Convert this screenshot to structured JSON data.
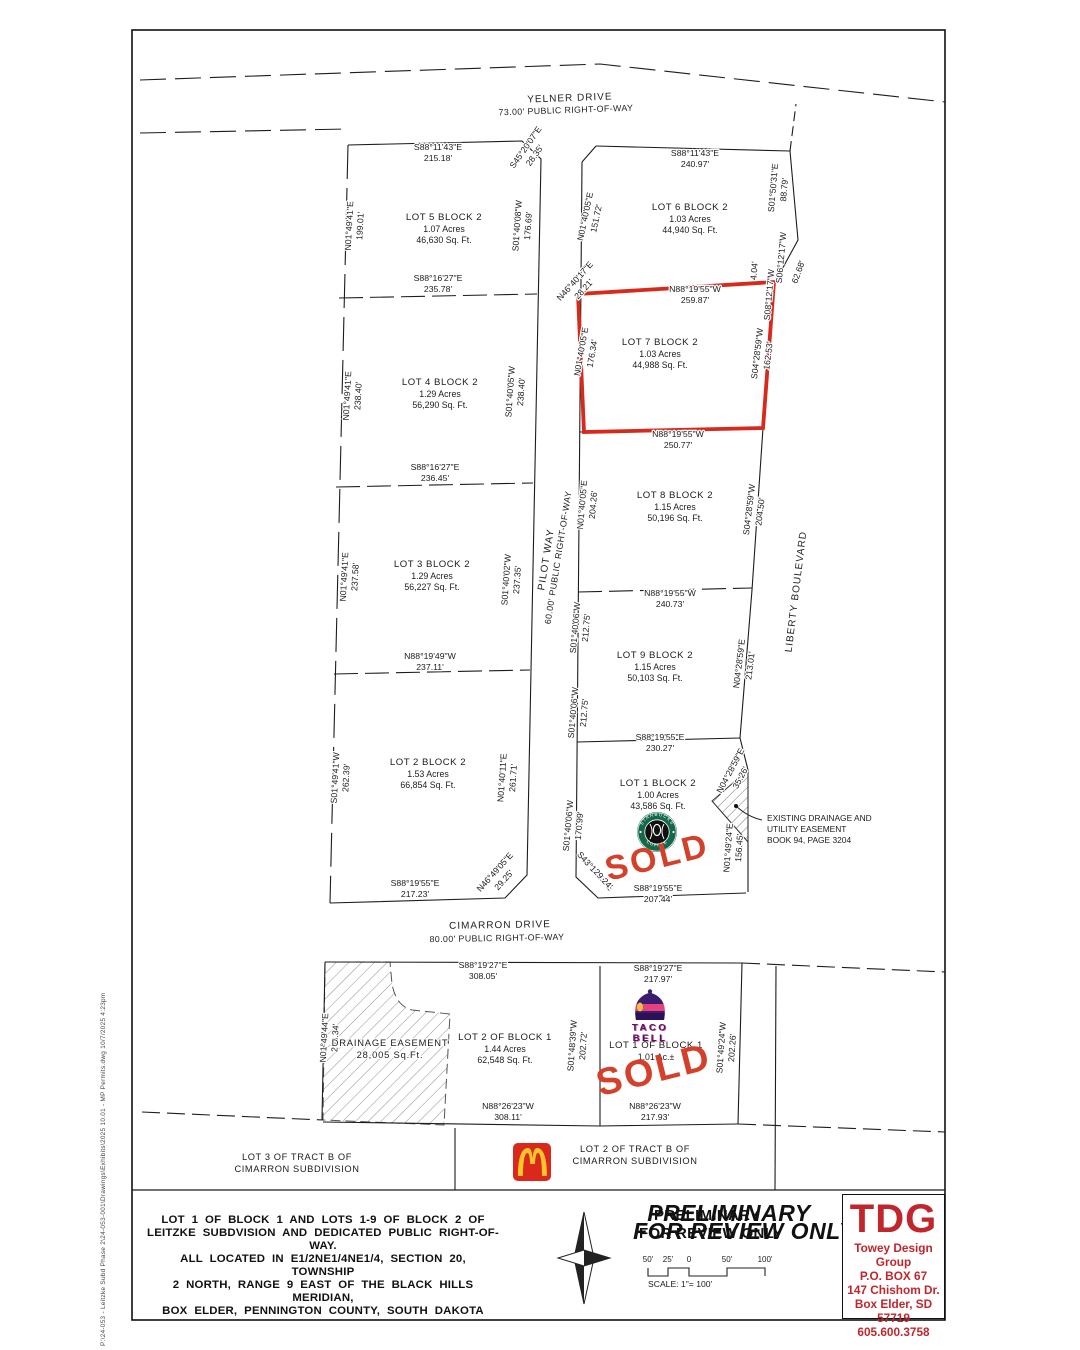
{
  "sheet": {
    "margin_note": "P:\\24-053 - Leitzke Subd Phase 2\\24-053-001\\Drawings\\Exhibits\\2025 10.01 - MP Permits.dwg   10/7/2025  4:23pm"
  },
  "streets": [
    {
      "name": "YELNER DRIVE",
      "detail": "73.00' PUBLIC RIGHT-OF-WAY",
      "nx": 570,
      "ny": 101,
      "nr": -2,
      "dx": 566,
      "dy": 113,
      "dr": -2
    },
    {
      "name": "PILOT WAY",
      "detail": "60.00' PUBLIC RIGHT-OF-WAY",
      "nx": 549,
      "ny": 560,
      "nr": -81,
      "dx": 561,
      "dy": 558,
      "dr": -81
    },
    {
      "name": "CIMARRON DRIVE",
      "detail": "80.00' PUBLIC RIGHT-OF-WAY",
      "nx": 500,
      "ny": 928,
      "nr": -1,
      "dx": 497,
      "dy": 941,
      "dr": -1
    },
    {
      "name": "LIBERTY BOULEVARD",
      "detail": "",
      "nx": 799,
      "ny": 592,
      "nr": -83,
      "dx": 0,
      "dy": 0,
      "dr": 0
    }
  ],
  "lots": [
    {
      "name": "LOT 5 BLOCK 2",
      "acres": "1.07 Acres",
      "sqft": "46,630 Sq. Ft.",
      "x": 444,
      "y": 220
    },
    {
      "name": "LOT 4 BLOCK 2",
      "acres": "1.29 Acres",
      "sqft": "56,290 Sq. Ft.",
      "x": 440,
      "y": 385
    },
    {
      "name": "LOT 3 BLOCK 2",
      "acres": "1.29 Acres",
      "sqft": "56,227 Sq. Ft.",
      "x": 432,
      "y": 567
    },
    {
      "name": "LOT 2 BLOCK 2",
      "acres": "1.53 Acres",
      "sqft": "66,854 Sq. Ft.",
      "x": 428,
      "y": 765
    },
    {
      "name": "LOT 6 BLOCK 2",
      "acres": "1.03 Acres",
      "sqft": "44,940 Sq. Ft.",
      "x": 690,
      "y": 210
    },
    {
      "name": "LOT 7 BLOCK 2",
      "acres": "1.03 Acres",
      "sqft": "44,988 Sq. Ft.",
      "x": 660,
      "y": 345
    },
    {
      "name": "LOT 8 BLOCK 2",
      "acres": "1.15 Acres",
      "sqft": "50,196 Sq. Ft.",
      "x": 675,
      "y": 498
    },
    {
      "name": "LOT 9 BLOCK 2",
      "acres": "1.15 Acres",
      "sqft": "50,103 Sq. Ft.",
      "x": 655,
      "y": 658
    },
    {
      "name": "LOT 1 BLOCK 2",
      "acres": "1.00 Acres",
      "sqft": "43,586 Sq. Ft.",
      "x": 658,
      "y": 786
    },
    {
      "name": "LOT 2 OF BLOCK 1",
      "acres": "1.44 Acres",
      "sqft": "62,548 Sq. Ft.",
      "x": 505,
      "y": 1040
    },
    {
      "name": "LOT 1 OF BLOCK 1",
      "acres": "1.01 Ac.±",
      "sqft": "",
      "x": 656,
      "y": 1048
    }
  ],
  "bearings": [
    {
      "t": "S88°11'43\"E",
      "x": 438,
      "y": 150
    },
    {
      "t": "215.18'",
      "x": 438,
      "y": 161
    },
    {
      "t": "S45°20'07\"E",
      "x": 528,
      "y": 149,
      "r": -55
    },
    {
      "t": "28.35'",
      "x": 537,
      "y": 157,
      "r": -55
    },
    {
      "t": "S88°11'43\"E",
      "x": 695,
      "y": 156
    },
    {
      "t": "240.97'",
      "x": 695,
      "y": 167
    },
    {
      "t": "N01°49'41\"E",
      "x": 352,
      "y": 226,
      "r": -87
    },
    {
      "t": "199.01'",
      "x": 363,
      "y": 226,
      "r": -87
    },
    {
      "t": "S01°40'08\"W",
      "x": 520,
      "y": 226,
      "r": -86
    },
    {
      "t": "176.69'",
      "x": 531,
      "y": 226,
      "r": -86
    },
    {
      "t": "S88°16'27\"E",
      "x": 438,
      "y": 281
    },
    {
      "t": "235.78'",
      "x": 438,
      "y": 292
    },
    {
      "t": "N01°49'41\"E",
      "x": 350,
      "y": 396,
      "r": -87
    },
    {
      "t": "238.40'",
      "x": 361,
      "y": 396,
      "r": -87
    },
    {
      "t": "S01°40'05\"W",
      "x": 513,
      "y": 392,
      "r": -86
    },
    {
      "t": "238.40'",
      "x": 524,
      "y": 392,
      "r": -86
    },
    {
      "t": "S88°16'27\"E",
      "x": 435,
      "y": 470
    },
    {
      "t": "236.45'",
      "x": 435,
      "y": 481
    },
    {
      "t": "N01°49'41\"E",
      "x": 347,
      "y": 577,
      "r": -87
    },
    {
      "t": "237.58'",
      "x": 358,
      "y": 577,
      "r": -87
    },
    {
      "t": "S01°40'02\"W",
      "x": 509,
      "y": 580,
      "r": -86
    },
    {
      "t": "237.35'",
      "x": 520,
      "y": 580,
      "r": -86
    },
    {
      "t": "N88°19'49\"W",
      "x": 430,
      "y": 659
    },
    {
      "t": "237.11'",
      "x": 430,
      "y": 670
    },
    {
      "t": "S01°49'41\"W",
      "x": 338,
      "y": 778,
      "r": -87
    },
    {
      "t": "262.39'",
      "x": 349,
      "y": 778,
      "r": -87
    },
    {
      "t": "N01°40'11\"E",
      "x": 505,
      "y": 778,
      "r": -86
    },
    {
      "t": "261.71'",
      "x": 516,
      "y": 778,
      "r": -86
    },
    {
      "t": "S88°19'55\"E",
      "x": 415,
      "y": 886
    },
    {
      "t": "217.23'",
      "x": 415,
      "y": 897
    },
    {
      "t": "N46°49'05\"E",
      "x": 497,
      "y": 874,
      "r": -48
    },
    {
      "t": "29.25'",
      "x": 506,
      "y": 882,
      "r": -48
    },
    {
      "t": "N01°40'05\"E",
      "x": 588,
      "y": 217,
      "r": -78
    },
    {
      "t": "151.72'",
      "x": 599,
      "y": 219,
      "r": -78
    },
    {
      "t": "S01°50'31\"E",
      "x": 776,
      "y": 188,
      "r": -85
    },
    {
      "t": "88.79'",
      "x": 787,
      "y": 190,
      "r": -85
    },
    {
      "t": "S06°12'17\"W",
      "x": 784,
      "y": 258,
      "r": -85
    },
    {
      "t": "S08°12'17\"W",
      "x": 772,
      "y": 295,
      "r": -85
    },
    {
      "t": "4.04'",
      "x": 757,
      "y": 271,
      "r": -85
    },
    {
      "t": "62.68'",
      "x": 801,
      "y": 273,
      "r": -70
    },
    {
      "t": "N88°19'55\"W",
      "x": 695,
      "y": 292
    },
    {
      "t": "259.87'",
      "x": 695,
      "y": 303
    },
    {
      "t": "N46°40'17\"E",
      "x": 577,
      "y": 283,
      "r": -48
    },
    {
      "t": "28.21'",
      "x": 586,
      "y": 291,
      "r": -48
    },
    {
      "t": "N01°40'05\"E",
      "x": 584,
      "y": 352,
      "r": -80
    },
    {
      "t": "176.34'",
      "x": 595,
      "y": 354,
      "r": -80
    },
    {
      "t": "S04°28'59\"W",
      "x": 760,
      "y": 354,
      "r": -83
    },
    {
      "t": "162.53'",
      "x": 771,
      "y": 356,
      "r": -83
    },
    {
      "t": "N88°19'55\"W",
      "x": 678,
      "y": 437
    },
    {
      "t": "250.77'",
      "x": 678,
      "y": 448
    },
    {
      "t": "N01°40'05\"E",
      "x": 585,
      "y": 505,
      "r": -85
    },
    {
      "t": "204.26'",
      "x": 596,
      "y": 505,
      "r": -85
    },
    {
      "t": "S04°28'59\"W",
      "x": 752,
      "y": 510,
      "r": -83
    },
    {
      "t": "204.50'",
      "x": 763,
      "y": 512,
      "r": -83
    },
    {
      "t": "N88°19'55\"W",
      "x": 670,
      "y": 596
    },
    {
      "t": "240.73'",
      "x": 670,
      "y": 607
    },
    {
      "t": "S01°40'06\"W",
      "x": 578,
      "y": 628,
      "r": -85
    },
    {
      "t": "212.75'",
      "x": 589,
      "y": 628,
      "r": -85
    },
    {
      "t": "S01°40'06\"W",
      "x": 576,
      "y": 713,
      "r": -85
    },
    {
      "t": "212.75'",
      "x": 587,
      "y": 713,
      "r": -85
    },
    {
      "t": "N04°28'59\"E",
      "x": 742,
      "y": 664,
      "r": -83
    },
    {
      "t": "213.01'",
      "x": 753,
      "y": 666,
      "r": -83
    },
    {
      "t": "S88°19'55\"E",
      "x": 660,
      "y": 740
    },
    {
      "t": "230.27'",
      "x": 660,
      "y": 751
    },
    {
      "t": "N04°28'59\"E",
      "x": 733,
      "y": 772,
      "r": -62
    },
    {
      "t": "35.26'",
      "x": 743,
      "y": 779,
      "r": -62
    },
    {
      "t": "S01°40'06\"W",
      "x": 571,
      "y": 826,
      "r": -85
    },
    {
      "t": "170.99'",
      "x": 582,
      "y": 826,
      "r": -85
    },
    {
      "t": "N01°49'24\"E",
      "x": 731,
      "y": 848,
      "r": -86
    },
    {
      "t": "156.45'",
      "x": 742,
      "y": 848,
      "r": -86
    },
    {
      "t": "S43°19'55\"E",
      "x": 593,
      "y": 873,
      "r": 48
    },
    {
      "t": "29.24'",
      "x": 601,
      "y": 881,
      "r": 48
    },
    {
      "t": "S88°19'55\"E",
      "x": 658,
      "y": 891
    },
    {
      "t": "207.44'",
      "x": 658,
      "y": 902
    },
    {
      "t": "S88°19'27\"E",
      "x": 483,
      "y": 968
    },
    {
      "t": "308.05'",
      "x": 483,
      "y": 979
    },
    {
      "t": "S88°19'27\"E",
      "x": 658,
      "y": 971
    },
    {
      "t": "217.97'",
      "x": 658,
      "y": 982
    },
    {
      "t": "N01°49'44\"E",
      "x": 327,
      "y": 1038,
      "r": -87
    },
    {
      "t": "203.34'",
      "x": 338,
      "y": 1038,
      "r": -87
    },
    {
      "t": "S01°48'39\"W",
      "x": 575,
      "y": 1046,
      "r": -86
    },
    {
      "t": "202.72'",
      "x": 586,
      "y": 1046,
      "r": -86
    },
    {
      "t": "S01°49'24\"W",
      "x": 724,
      "y": 1048,
      "r": -86
    },
    {
      "t": "202.26'",
      "x": 735,
      "y": 1048,
      "r": -86
    },
    {
      "t": "N88°26'23\"W",
      "x": 508,
      "y": 1109
    },
    {
      "t": "308.11'",
      "x": 508,
      "y": 1120
    },
    {
      "t": "N88°26'23\"W",
      "x": 655,
      "y": 1109
    },
    {
      "t": "217.93'",
      "x": 655,
      "y": 1120
    }
  ],
  "easement_note": {
    "lines": [
      "EXISTING DRAINAGE AND",
      "UTILITY EASEMENT",
      "BOOK 94, PAGE 3204"
    ],
    "x": 767,
    "y": 821
  },
  "drainage_easement": {
    "lines": [
      "DRAINAGE  EASEMENT",
      "28,005  Sq.Ft."
    ],
    "x": 390,
    "y": 1046
  },
  "tract_notes": [
    {
      "lines": [
        "LOT 3 OF TRACT B OF",
        "CIMARRON SUBDIVISION"
      ],
      "x": 297,
      "y": 1160
    },
    {
      "lines": [
        "LOT 2 OF TRACT B OF",
        "CIMARRON SUBDIVISION"
      ],
      "x": 635,
      "y": 1152
    }
  ],
  "sold": {
    "text": "SOLD",
    "positions": [
      {
        "x": 660,
        "y": 868,
        "r": -14,
        "s": 34
      },
      {
        "x": 657,
        "y": 1082,
        "r": -14,
        "s": 38
      }
    ]
  },
  "logos": {
    "starbucks": {
      "ring_top": "STARBUCKS",
      "ring_bottom": "COFFEE"
    },
    "tacobell": {
      "word1": "TACO",
      "word2": "BELL"
    }
  },
  "legal_description": [
    "LOT 1 OF BLOCK 1 AND LOTS 1-9 OF BLOCK 2 OF",
    "LEITZKE SUBDVISION AND DEDICATED PUBLIC RIGHT-OF-WAY.",
    "ALL LOCATED IN E1/2NE1/4NE1/4, SECTION 20, TOWNSHIP",
    "2 NORTH, RANGE 9 EAST OF THE BLACK HILLS MERIDIAN,",
    "BOX ELDER, PENNINGTON COUNTY, SOUTH DAKOTA"
  ],
  "preliminary": {
    "line1": "PRELIMINARY",
    "line2": "FOR REVIEW ONLY"
  },
  "scale_bar": {
    "labels": [
      "50'",
      "25'",
      "0",
      "50'",
      "100'"
    ],
    "caption": "SCALE: 1\"= 100'"
  },
  "title_block": {
    "initials": "TDG",
    "company": "Towey Design Group",
    "po_box": "P.O. BOX 67",
    "street": "147 Chishom Dr.",
    "city": "Box Elder, SD 57719",
    "phone": "605.600.3758"
  },
  "colors": {
    "highlight": "#d8291d",
    "sold": "#d5402b",
    "tdg_red": "#c0272d",
    "starbucks_green": "#14694a",
    "tacobell_purple": "#3b1c71",
    "tacobell_pink": "#e8427c",
    "mcdonalds_red": "#da291c",
    "mcdonalds_yellow": "#fdc52c"
  }
}
